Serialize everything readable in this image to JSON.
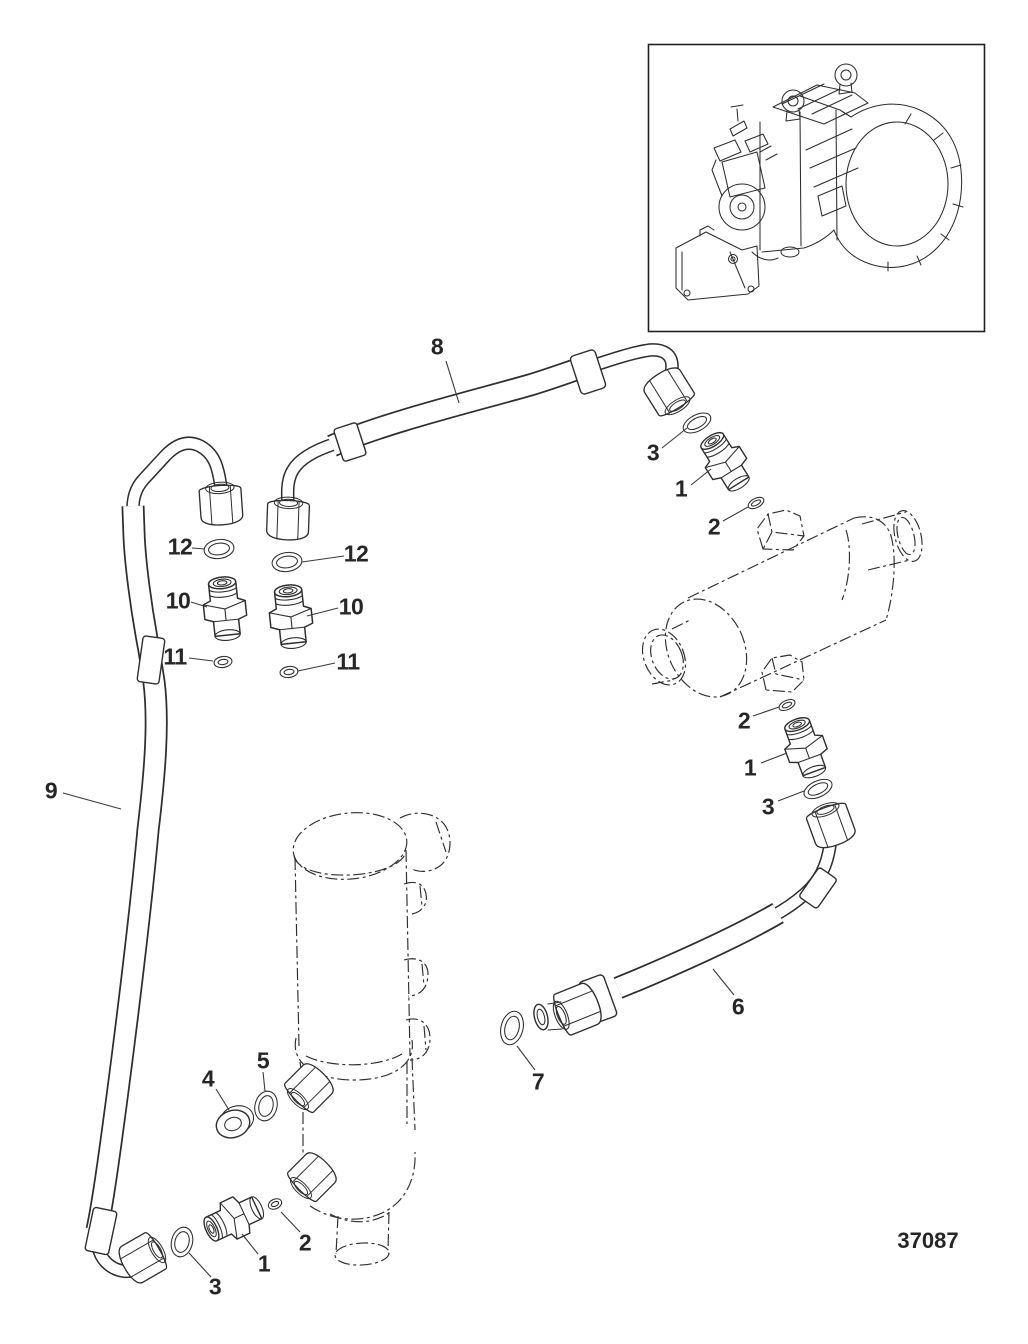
{
  "drawing_number": "37087",
  "colors": {
    "line": "#2e2e2e",
    "background": "#ffffff",
    "label": "#262626"
  },
  "callouts": [
    {
      "text": "8"
    },
    {
      "text": "3"
    },
    {
      "text": "1"
    },
    {
      "text": "2"
    },
    {
      "text": "2"
    },
    {
      "text": "1"
    },
    {
      "text": "3"
    },
    {
      "text": "6"
    },
    {
      "text": "7"
    },
    {
      "text": "12"
    },
    {
      "text": "10"
    },
    {
      "text": "11"
    },
    {
      "text": "12"
    },
    {
      "text": "10"
    },
    {
      "text": "11"
    },
    {
      "text": "9"
    },
    {
      "text": "5"
    },
    {
      "text": "4"
    },
    {
      "text": "3"
    },
    {
      "text": "1"
    },
    {
      "text": "2"
    }
  ]
}
